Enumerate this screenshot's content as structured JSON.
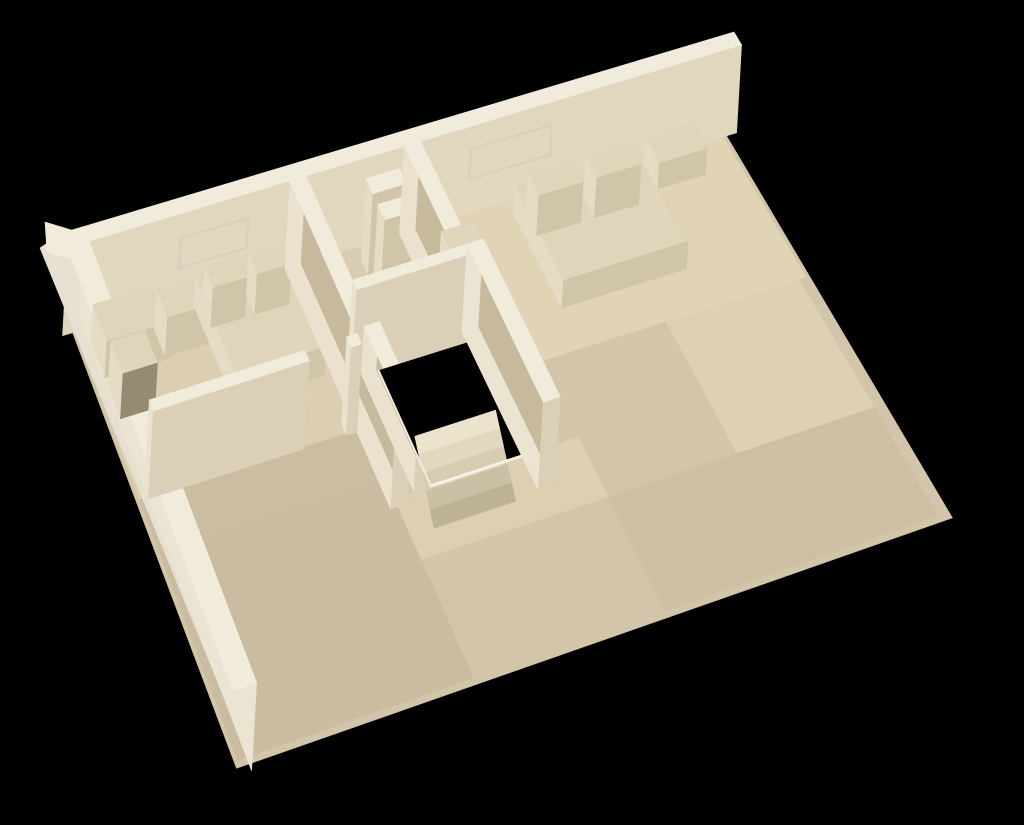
{
  "scene": {
    "title": "Photograph of a cream 3D-printed architectural model of a single-storey house floor plan, viewed from above at an angle on a black background",
    "background": "#000000"
  },
  "palette": {
    "bg": "#000000",
    "extBright": "#f3eee3",
    "extLight": "#efe9db",
    "extShade": "#e7dfcf",
    "wallTop": "#f1ebdb",
    "faceS": "#dbd0b7",
    "faceE": "#c6b99c",
    "faceW": "#eae2ce",
    "faceN": "#d6cab1",
    "intW": "#ece4d2",
    "intE": "#e8dfc9",
    "intN": "#e1d6be",
    "intS": "#cfc3a8",
    "floor": "#d2c5aa",
    "floorWarm": "#ecdfbe",
    "floorCool": "#c3b498",
    "furnTop": "#e0d5bb",
    "furnS": "#d1c5a9",
    "furnE": "#beb194",
    "furnW": "#e5dcc5",
    "furnDark": "#968a72",
    "white": "#f6f1e5",
    "groove": "#d8cfbc",
    "tubInner": "#a79a7f",
    "black": "#000000",
    "shadowTint": "#5a4722",
    "tread1": "#ece3cd",
    "tread2": "#e2d8c0",
    "tread3": "#d7ccb2",
    "tread4": "#cabfa4",
    "tread5": "#bdb196"
  }
}
